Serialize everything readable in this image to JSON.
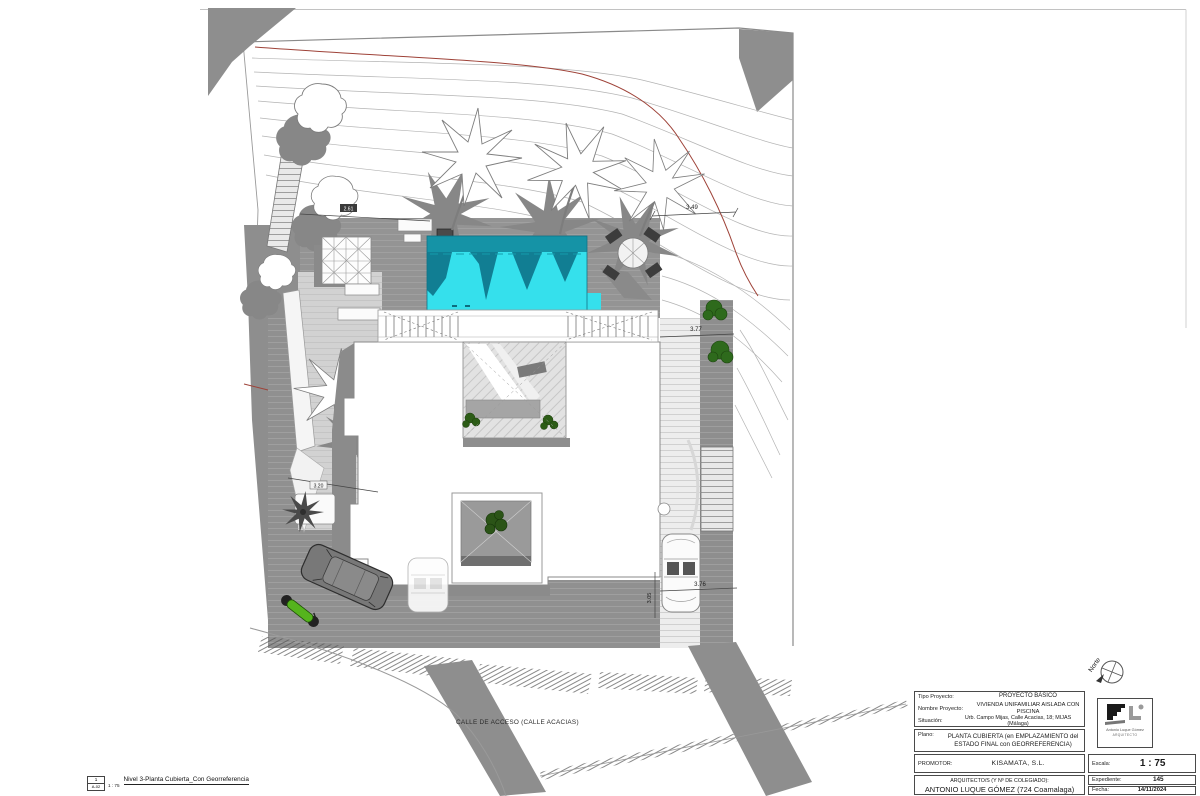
{
  "drawing": {
    "street_label": "CALLE DE ACCESO (CALLE ACACIAS)",
    "north_label": "Norte",
    "dims": {
      "top_right": "3.49",
      "right_path": "3.77",
      "car_width": "3.76",
      "car_height": "3.05",
      "left_diag": "3.20",
      "deck_top": "2.61"
    },
    "colors": {
      "pool_water": "#35e0ec",
      "pool_shadow": "#117e93",
      "terrain_gray": "#8e8e8e",
      "contour_red": "#9e4238",
      "plant_green": "#2e6a1c",
      "moto_green": "#55b41d"
    }
  },
  "legend": {
    "number": "1",
    "sheet_code": "A-02",
    "scale": "1 : 75",
    "title": "Nivel 3-Planta Cubierta_Con Georreferencia"
  },
  "title_block": {
    "tipo_label": "Tipo Proyecto:",
    "tipo_value": "PROYECTO BÁSICO",
    "nombre_label": "Nombre Proyecto:",
    "nombre_value": "VIVIENDA UNIFAMILIAR AISLADA CON PISCINA",
    "situacion_label": "Situación:",
    "situacion_value": "Urb. Campo Mijas, Calle Acacias, 18; MIJAS (Málaga)",
    "plano_label": "Plano:",
    "plano_value": "PLANTA CUBIERTA (en EMPLAZAMIENTO del ESTADO FINAL con GEORREFERENCIA)",
    "promotor_label": "PROMOTOR:",
    "promotor_value": "KISAMATA, S.L.",
    "arquitecto_label": "ARQUITECTO/S (Y Nº DE COLEGIADO):",
    "arquitecto_value": "ANTONIO LUQUE GÓMEZ (724 Coamalaga)",
    "escala_label": "Escala:",
    "escala_value": "1 : 75",
    "expediente_label": "Expediente:",
    "expediente_value": "145",
    "fecha_label": "Fecha:",
    "fecha_value": "14/11/2024",
    "logo_name": "Antonio Luque Gómez",
    "logo_role": "ARQUITECTO"
  }
}
